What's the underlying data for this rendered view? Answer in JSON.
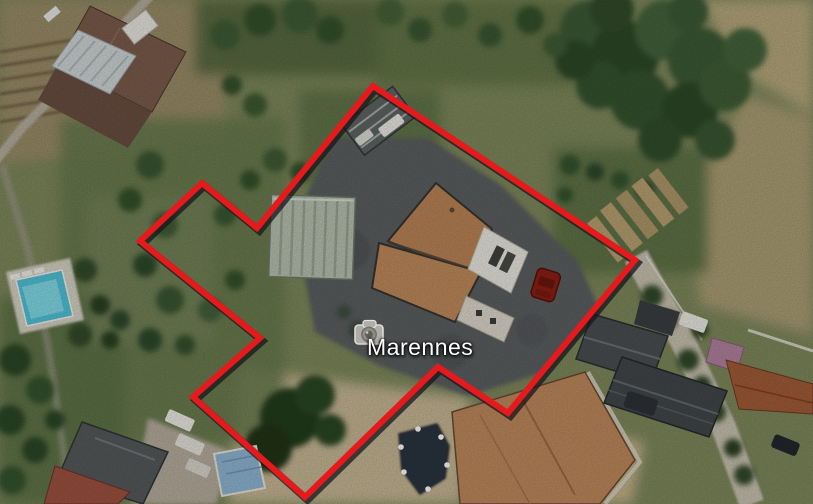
{
  "app": {
    "view": "aerial-satellite-map"
  },
  "map": {
    "place_label": {
      "text": "Marennes",
      "x": 367,
      "y": 334,
      "font_size": 23,
      "color": "#ffffff"
    },
    "photo_icon": {
      "name": "camera-photo-placemark",
      "x": 352,
      "y": 317,
      "width": 36,
      "height": 32
    },
    "parcel_outline": {
      "color": "#e61a1c",
      "shadow_color": "#15171b",
      "stroke_width": 6,
      "shadow_width": 7.5,
      "shadow_offset": [
        2.5,
        3
      ],
      "points": [
        [
          373,
          86
        ],
        [
          635,
          260
        ],
        [
          508,
          413
        ],
        [
          438,
          367
        ],
        [
          305,
          497
        ],
        [
          193,
          397
        ],
        [
          260,
          338
        ],
        [
          140,
          241
        ],
        [
          202,
          183
        ],
        [
          257,
          228
        ]
      ]
    },
    "scene_features": [
      "tiled-roof-house",
      "barn",
      "greenhouses",
      "swimming-pools",
      "asphalt-driveway",
      "red-car",
      "covered-boat",
      "tree-clusters",
      "garden-beds",
      "village-roads",
      "grey-roof-buildings"
    ]
  }
}
